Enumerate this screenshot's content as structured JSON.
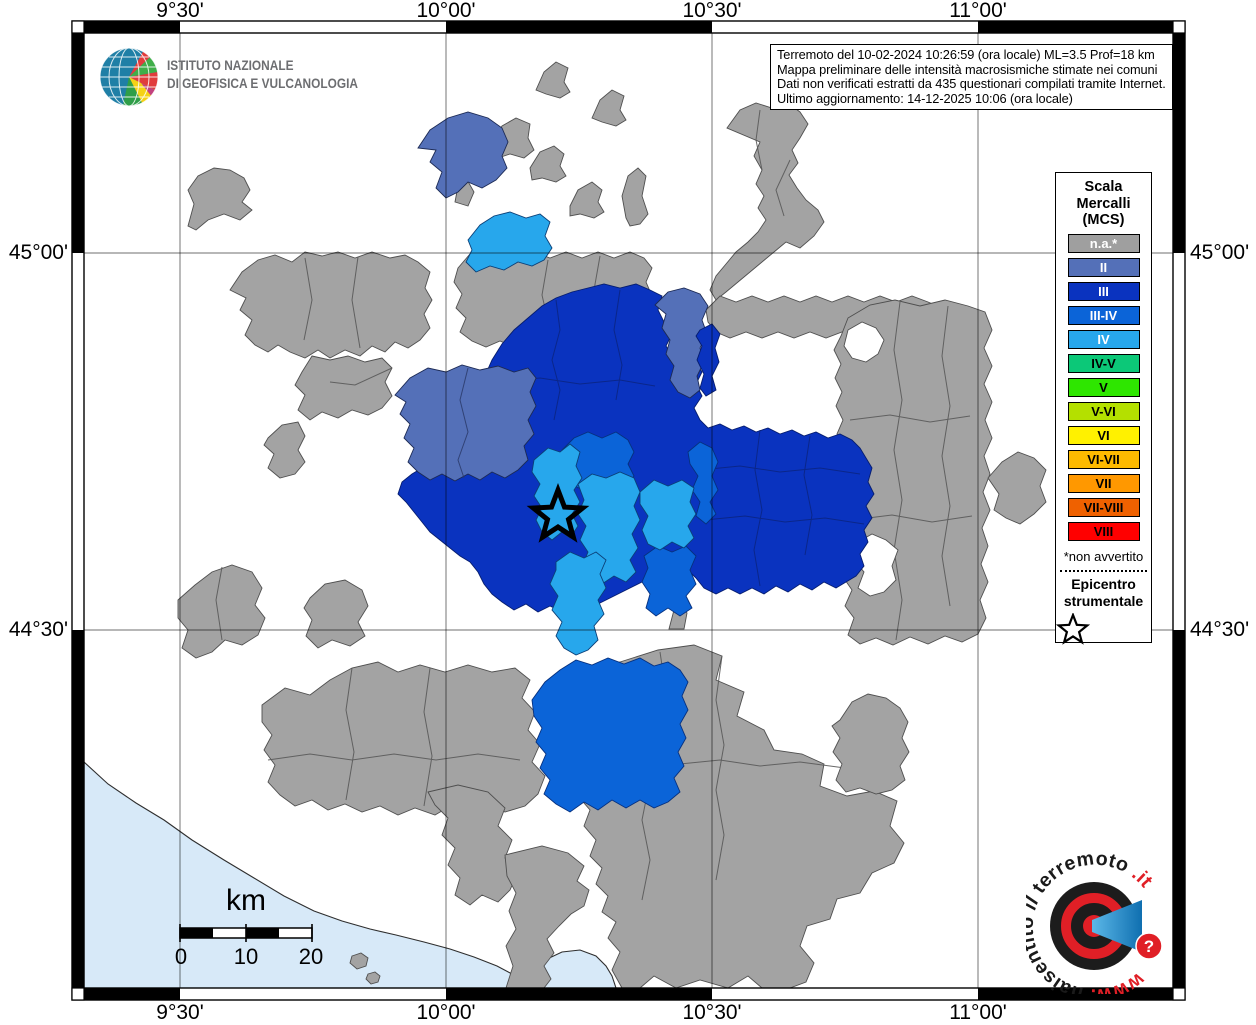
{
  "branding": {
    "ingv": {
      "line1": "ISTITUTO NAZIONALE",
      "line2": "DI GEOFISICA E VULCANOLOGIA"
    },
    "website": {
      "www": "www.",
      "part1": "haisentito",
      "part2": "il",
      "part3": "terremoto",
      "part4": ".it",
      "question": "?"
    }
  },
  "info_box": {
    "lines": [
      "Terremoto del 10-02-2024 10:26:59 (ora locale) ML=3.5 Prof=18 km",
      "Mappa preliminare delle intensità macrosismiche stimate nei comuni",
      "Dati non verificati estratti da 435 questionari compilati tramite Internet.",
      "Ultimo aggiornamento: 14-12-2025 10:06 (ora locale)"
    ]
  },
  "axes": {
    "top": [
      {
        "label": "9°30'"
      },
      {
        "label": "10°00'"
      },
      {
        "label": "10°30'"
      },
      {
        "label": "11°00'"
      }
    ],
    "bottom": [
      {
        "label": "9°30'"
      },
      {
        "label": "10°00'"
      },
      {
        "label": "10°30'"
      },
      {
        "label": "11°00'"
      }
    ],
    "left": [
      {
        "label": "45°00'"
      },
      {
        "label": "44°30'"
      }
    ],
    "right": [
      {
        "label": "45°00'"
      },
      {
        "label": "44°30'"
      }
    ]
  },
  "legend": {
    "title_lines": [
      "Scala",
      "Mercalli",
      "(MCS)"
    ],
    "items": [
      {
        "label": "n.a.*",
        "color": "#9f9f9f",
        "text_color": "#ffffff"
      },
      {
        "label": "II",
        "color": "#5470b8",
        "text_color": "#ffffff"
      },
      {
        "label": "III",
        "color": "#0a33bf",
        "text_color": "#ffffff"
      },
      {
        "label": "III-IV",
        "color": "#0b64d8",
        "text_color": "#ffffff"
      },
      {
        "label": "IV",
        "color": "#27a7ec",
        "text_color": "#ffffff"
      },
      {
        "label": "IV-V",
        "color": "#0cc878",
        "text_color": "#000000"
      },
      {
        "label": "V",
        "color": "#2ee600",
        "text_color": "#000000"
      },
      {
        "label": "V-VI",
        "color": "#b4e000",
        "text_color": "#000000"
      },
      {
        "label": "VI",
        "color": "#fff100",
        "text_color": "#000000"
      },
      {
        "label": "VI-VII",
        "color": "#fdba00",
        "text_color": "#000000"
      },
      {
        "label": "VII",
        "color": "#ff9800",
        "text_color": "#000000"
      },
      {
        "label": "VII-VIII",
        "color": "#ef6100",
        "text_color": "#000000"
      },
      {
        "label": "VIII",
        "color": "#ff0000",
        "text_color": "#000000"
      }
    ],
    "footnote": "*non avvertito",
    "epicenter_lines": [
      "Epicentro",
      "strumentale"
    ]
  },
  "scale_bar": {
    "unit": "km",
    "tick0": "0",
    "tick1": "10",
    "tick2": "20"
  },
  "map_colors": {
    "sea": "#d7e9f8",
    "not_sampled": "#ffffff",
    "na_gray": "#a3a3a3"
  }
}
